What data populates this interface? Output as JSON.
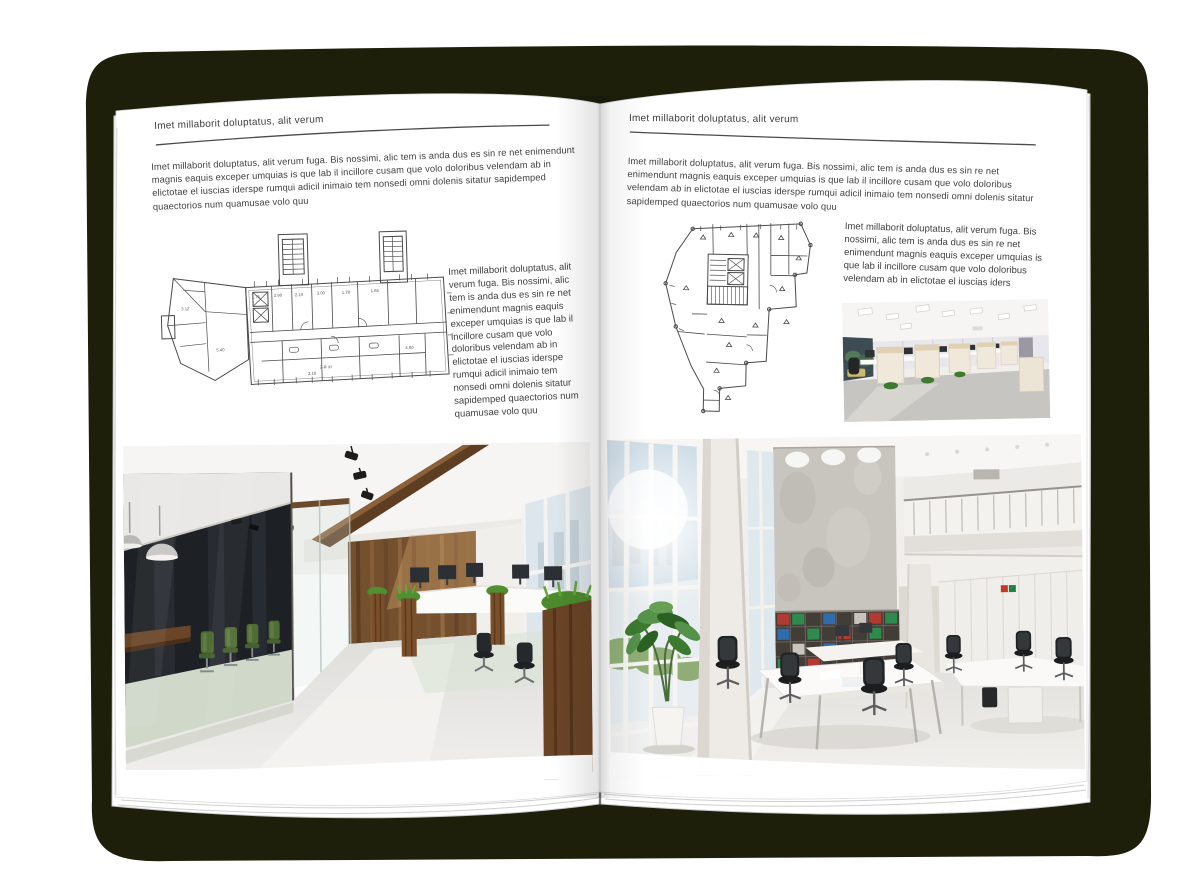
{
  "palette": {
    "backdrop": "#1d1f0b",
    "page": "#ffffff",
    "text": "#404040",
    "rule": "#4a4a4a",
    "plan_line": "#4a4a4a",
    "wood": "#74502f",
    "plant_green": "#4f8f2f"
  },
  "left_page": {
    "header": "Imet millaborit doluptatus, alit verum",
    "intro": "Imet millaborit doluptatus, alit verum fuga. Bis nossimi, alic tem is anda dus es sin re net enimendunt magnis eaquis exceper umquias is que lab il incillore cusam que volo doloribus velendam ab in elictotae el iuscias iderspe rumqui adicil inimaio tem nonsedi omni dolenis sitatur sapidemped quaectorios num quamusae volo quu",
    "side_text": "Imet millaborit doluptatus, alit verum fuga. Bis nossimi, alic tem is anda dus es sin re net enimendunt magnis eaquis exceper umquias is que lab il incillore cusam que volo doloribus velendam ab in elictotae el iuscias iderspe rumqui adicil inimaio tem nonsedi omni dolenis sitatur sapidemped quaectorios num quamusae volo quu",
    "floorplan": {
      "alt": "wide building floor plan with two stair towers",
      "hall_label": "2-й эт",
      "dims": [
        "1.75",
        "2.90",
        "2.10",
        "3.00",
        "1.78",
        "1.65",
        "5.40",
        "4.00",
        "3.12",
        "2.10"
      ]
    },
    "photo_alt": "loft office interior with dark glass meeting room, wood wall and workstations"
  },
  "right_page": {
    "header": "Imet millaborit doluptatus, alit verum",
    "intro": "Imet millaborit doluptatus, alit verum fuga. Bis nossimi, alic tem is anda dus es sin re net enimendunt magnis eaquis exceper umquias is que lab il incillore cusam que volo doloribus velendam ab in elictotae el iuscias iderspe rumqui adicil inimaio tem nonsedi omni dolenis sitatur sapidemped quaectorios num quamusae volo quu",
    "side_text": "Imet millaborit doluptatus, alit verum fuga. Bis nossimi, alic tem is anda dus es sin re net enimendunt magnis eaquis exceper umquias is que lab il incillore cusam que volo doloribus velendam ab in elictotae el iuscias iders",
    "floorplan": {
      "alt": "irregular tower floor plan with central core"
    },
    "photo_small_alt": "open plan office with beige workstation cubicles",
    "photo_alt": "bright double-height office atrium with white desks and shelving"
  }
}
